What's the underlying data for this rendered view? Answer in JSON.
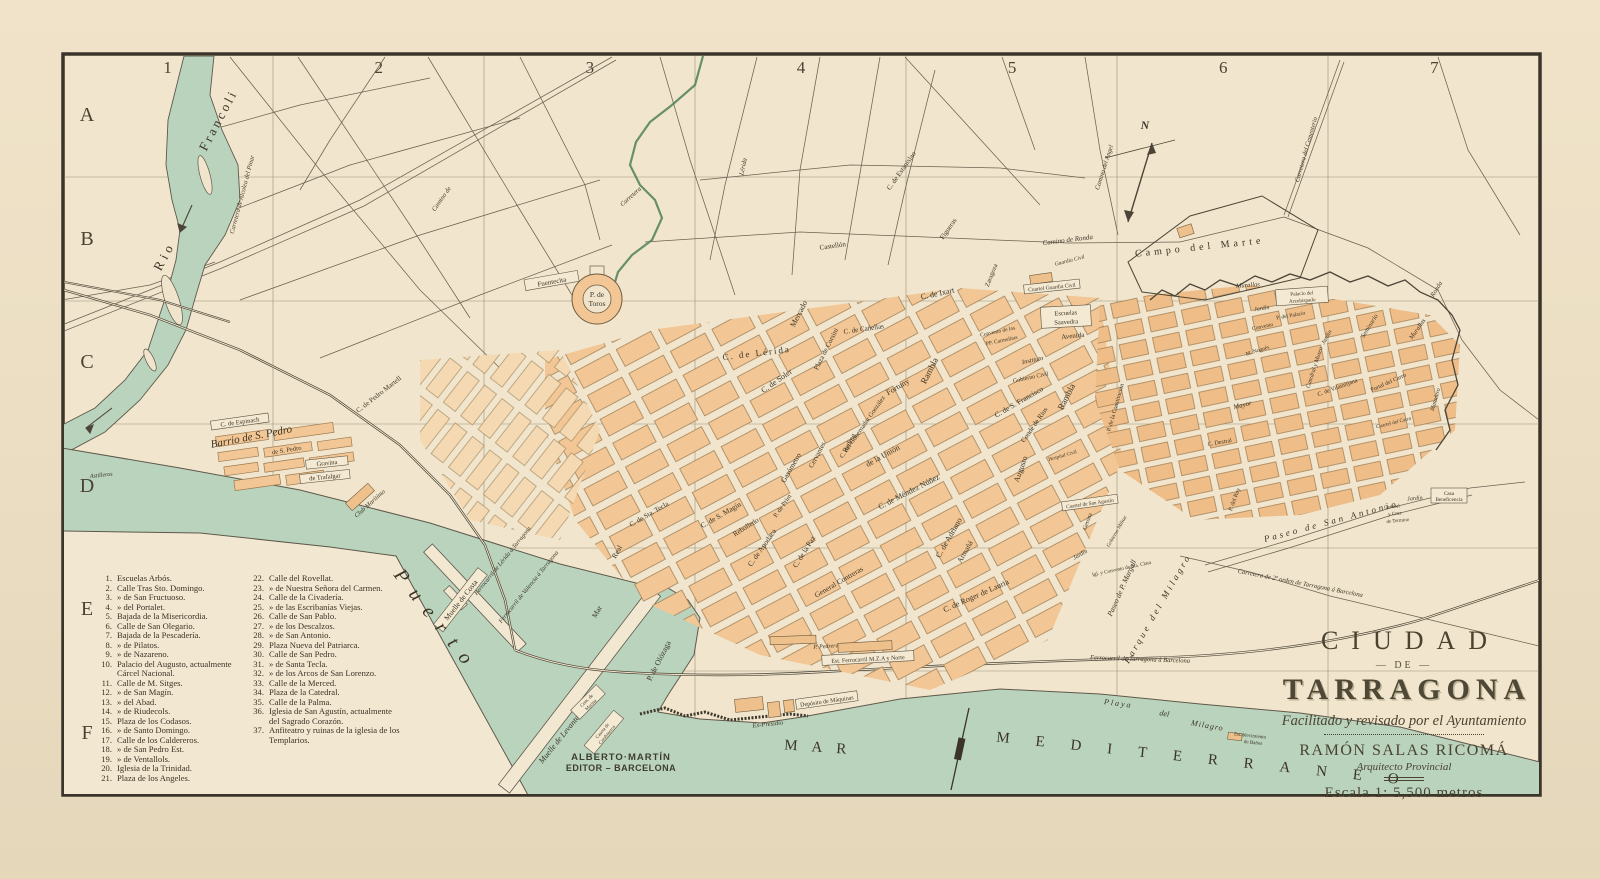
{
  "colors": {
    "paper": "#f1e6cd",
    "margin": "#ecdfc4",
    "water": "#b9d3bd",
    "water_edge": "#5f584a",
    "block": "#f2c795",
    "block_old": "#efbd88",
    "block_light": "#f5d9b3",
    "line": "#6b6152",
    "ink": "#3c3426"
  },
  "grid": {
    "columns": [
      "1",
      "2",
      "3",
      "4",
      "5",
      "6",
      "7"
    ],
    "rows": [
      "A",
      "B",
      "C",
      "D",
      "E",
      "F"
    ]
  },
  "title": {
    "ciudad": "CIUDAD",
    "de": "DE",
    "tarragona": "TARRAGONA",
    "subtitle": "Facilitado y revisado por el Ayuntamiento",
    "author": "RAMÓN SALAS RICOMÁ",
    "author_title": "Arquitecto Provincial",
    "scale": "Escala 1: 5,500 metros"
  },
  "publisher": {
    "line1": "ALBERTO·MARTÍN",
    "line2": "EDITOR – BARCELONA"
  },
  "legend": {
    "col1": [
      {
        "n": "1.",
        "t": "Escuelas Arbós."
      },
      {
        "n": "2.",
        "t": "Calle Tras Sto. Domingo."
      },
      {
        "n": "3.",
        "t": "»  de San Fructuoso."
      },
      {
        "n": "4.",
        "t": "»  del Portalet."
      },
      {
        "n": "5.",
        "t": "Bajada de la Misericordia."
      },
      {
        "n": "6.",
        "t": "Calle de San Olegario."
      },
      {
        "n": "7.",
        "t": "Bajada de la Pescadería."
      },
      {
        "n": "8.",
        "t": "»  de Pilatos."
      },
      {
        "n": "9.",
        "t": "»  de Nazareno."
      },
      {
        "n": "10.",
        "t": "Palacio del Augusto, actualmente Cárcel Nacional."
      },
      {
        "n": "11.",
        "t": "Calle de M. Sitges."
      },
      {
        "n": "12.",
        "t": "»  de San Magín."
      },
      {
        "n": "13.",
        "t": "»  del Abad."
      },
      {
        "n": "14.",
        "t": "»  de Riudecols."
      },
      {
        "n": "15.",
        "t": "Plaza de los Codasos."
      },
      {
        "n": "16.",
        "t": "»  de Santo Domingo."
      },
      {
        "n": "17.",
        "t": "Calle de los Caldereros."
      },
      {
        "n": "18.",
        "t": "»  de San Pedro Est."
      },
      {
        "n": "19.",
        "t": "»  de Ventallols."
      },
      {
        "n": "20.",
        "t": "Iglesia de la Trinidad."
      },
      {
        "n": "21.",
        "t": "Plaza de los Angeles."
      }
    ],
    "col2": [
      {
        "n": "22.",
        "t": "Calle del Rovellat."
      },
      {
        "n": "23.",
        "t": "»  de Nuestra Señora del Carmen."
      },
      {
        "n": "24.",
        "t": "Calle de la Civadería."
      },
      {
        "n": "25.",
        "t": "»  de las Escribanías Viejas."
      },
      {
        "n": "26.",
        "t": "Calle de San Pablo."
      },
      {
        "n": "27.",
        "t": "»  de los Descalzos."
      },
      {
        "n": "28.",
        "t": "»  de San Antonio."
      },
      {
        "n": "29.",
        "t": "Plaza Nueva del Patriarca."
      },
      {
        "n": "30.",
        "t": "Calle de San Pedro."
      },
      {
        "n": "31.",
        "t": "»  de Santa Tecla."
      },
      {
        "n": "32.",
        "t": "»  de los Arcos de San Lorenzo."
      },
      {
        "n": "33.",
        "t": "Calle de la Merced."
      },
      {
        "n": "34.",
        "t": "Plaza de la Catedral."
      },
      {
        "n": "35.",
        "t": "Calle de la Palma."
      },
      {
        "n": "36.",
        "t": "Iglesia de San Agustín, actualmente del Sagrado Corazón."
      },
      {
        "n": "37.",
        "t": "Anfiteatro y ruinas de la iglesia de los Templarios."
      }
    ]
  },
  "labels": {
    "rio": "Rio",
    "francoli": "Francoli",
    "astilleros": "Astilleros",
    "alcolea": "Carretera de Alcolea del Pinar",
    "camino_nw": "Camino de",
    "carretera_c": "Carretera",
    "lerida_rd": "Lérida",
    "fuentecita": "Fuentecita",
    "toros1": "P. de",
    "toros2": "Toros",
    "c_lerida": "C. de Lérida",
    "mercado": "Mercado",
    "corsini": "Plaza de Corsini",
    "c_soler": "C. de Soler",
    "c_ixart": "C. de Ixart",
    "rambla1": "Rambla",
    "rambla2": "Rambla",
    "carmelitas1": "Convento de los",
    "carmelitas2": "PP. Carmelitas",
    "saavedra1": "Escuelas",
    "saavedra2": "Saavedra",
    "avenida": "Avenida",
    "instituto": "Instituto",
    "gob_civil": "Gobierno Civil",
    "s_francisco": "C. de S. Francisco",
    "conde_rius": "Conde de Rius",
    "union": "de la Unión",
    "gobernador": "C. del Gobernador González",
    "fortuny": "Fortuny",
    "cervantes": "Cervantes",
    "reding": "Reding",
    "mendez": "C. de Méndez Núñez",
    "adriano": "C. de Adriano",
    "armana": "Armañá",
    "roger": "C. de Roger de Lauria",
    "augusto": "Augusto",
    "paz": "C. de la Paz",
    "contreras": "General Contreras",
    "apodaca": "C. de Apodaca",
    "s_magin": "C. de S. Magín",
    "sta_tecla": "C. de Sta. Tecla",
    "gasometro": "Gasómetro",
    "p_prim": "P. de Prim",
    "rebolledo": "Rebolledo",
    "olozaga": "P. de Olózaga",
    "real": "Real",
    "mar_st": "Mar",
    "muelle_costa": "Muelle de Costa",
    "fc_lerida": "Ferrocarril de Lérida á Tarragona",
    "fc_valencia": "Ferrocarril de Valencia á Tarragona",
    "muelle_levante": "Muelle de Levante",
    "caseta1": "Caseta de",
    "caseta2": "Carabineros",
    "marina1": "Com. de",
    "marina2": "Marina",
    "club": "Club Marítimo",
    "puerto": "Puerto",
    "barrio": "Barrio de S. Pedro",
    "espinach": "C. de Espinach",
    "s_pedro_st": "de S. Pedro",
    "gravina": "Gravina",
    "trafalgar": "de Trafalgar",
    "martell": "C. de Pedro Martell",
    "est_fc": "Est. Ferrocarril M.Z.A y Norte",
    "pedrera": "P. Pedrera",
    "deposito": "Depósito de Máquinas",
    "presidio": "Ex-Presidio",
    "mar": "MAR",
    "mediterraneo": "MEDITERRANEO",
    "playa": "Playa",
    "playa_del": "del",
    "milagro": "Milagro",
    "banos1": "Establecimiento",
    "banos2": "de Baños",
    "campo_marte": "Campo del Marte",
    "camino_angel": "Camino del Angel",
    "cementerio": "Carretera del Cementerio",
    "ronda": "Camino de Ronda",
    "ronda2": "Ronda",
    "guardia": "Guardia Civil",
    "cuartel_gc": "Cuartel Guardia Civil",
    "murallas1": "Murallas",
    "murallas2": "Murallas",
    "palacio1": "Palacio del",
    "palacio2": "Arzobispado",
    "jardin1": "Jardín",
    "p_palacio": "P. del Palacio",
    "catedral": "Catedral y Museo",
    "jardin2": "Jardín",
    "seminario": "Seminario",
    "convento": "Convento",
    "nogues": "M. Nogués",
    "mayor": "Mayor",
    "destral": "C. Destral",
    "vilamitjana": "C. de Vilamitjana",
    "portal": "Portal del Carro",
    "matadero": "Matadero",
    "cuartel_carro": "Cuartel del Carro",
    "constitucion": "P. de la Constitución",
    "paseo_sa": "Paseo de San Antonio",
    "margall": "Paseo de P. Margall",
    "parque": "Parque del Milagro",
    "orden2": "Carretera de 2º orden de Tarragona á Barcelona",
    "fc_bcn": "Ferrocarril de Tarragona á Barcelona",
    "jardin3": "Jardín",
    "benef1": "Casa",
    "benef2": "Beneficencia",
    "cruz1": "General",
    "cruz2": "y Cruz",
    "cruz3": "de Termino",
    "cuartel_sa": "Cuartel de San Agustín",
    "gob_militar": "Gobierno Militar",
    "sta_clara": "Igl. y Convento de Sta. Clara",
    "jardin4": "Jardín",
    "p_rey": "P. del Rey",
    "gerona": "Gerona",
    "hospital": "Hospital Civil",
    "canellas": "C. de Cañellas",
    "estanislao": "C. de Estanislao",
    "figueras": "Figueras",
    "castellon": "Castellón",
    "zaragoza": "Zaragoza",
    "compass_n": "N"
  }
}
